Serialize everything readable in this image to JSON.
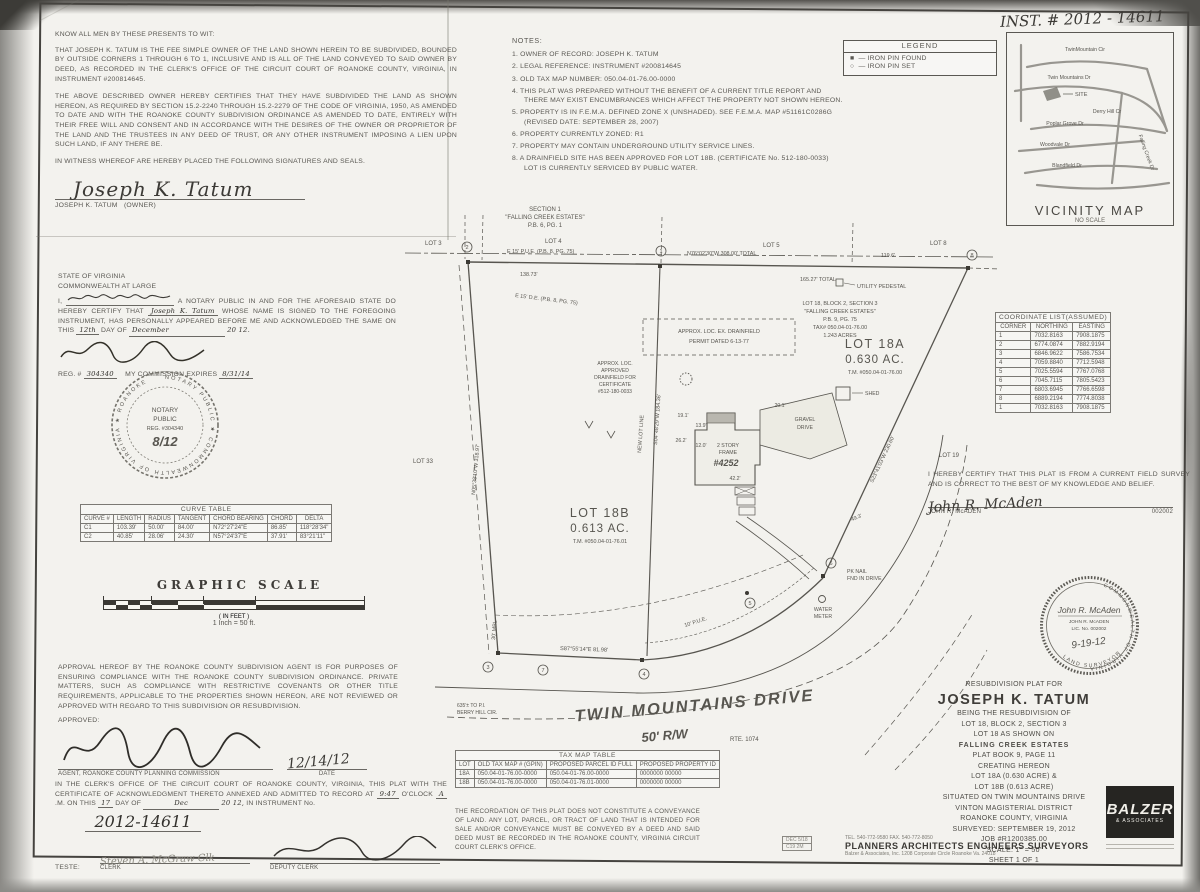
{
  "colors": {
    "paper": "#f3f2ee",
    "ink": "#57554f",
    "line": "#4c4a46",
    "hand": "#3c3a36",
    "logo_bg": "#262522"
  },
  "meta": {
    "inst_handwritten": "INST. # 2012 - 14611"
  },
  "owner": {
    "heading": "KNOW ALL MEN BY THESE PRESENTS TO WIT:",
    "p1": "THAT JOSEPH K. TATUM IS THE FEE SIMPLE OWNER OF THE LAND SHOWN HEREIN TO BE SUBDIVIDED, BOUNDED BY OUTSIDE CORNERS 1 THROUGH 6 TO 1, INCLUSIVE AND IS ALL OF THE LAND CONVEYED TO SAID OWNER BY DEED, AS RECORDED IN THE CLERK'S OFFICE OF THE CIRCUIT COURT OF ROANOKE COUNTY, VIRGINIA, IN INSTRUMENT #200814645.",
    "p2": "THE ABOVE DESCRIBED OWNER HEREBY CERTIFIES THAT THEY HAVE SUBDIVIDED THE LAND AS SHOWN HEREON, AS REQUIRED BY SECTION 15.2-2240 THROUGH 15.2-2279 OF THE CODE OF VIRGINIA, 1950, AS AMENDED TO DATE AND WITH THE ROANOKE COUNTY SUBDIVISION ORDINANCE AS AMENDED TO DATE, ENTIRELY WITH THEIR FREE WILL AND CONSENT AND IN ACCORDANCE WITH THE DESIRES OF THE OWNER OR PROPRIETOR OF THE LAND AND THE TRUSTEES IN ANY DEED OF TRUST, OR ANY OTHER INSTRUMENT IMPOSING A LIEN UPON SUCH LAND, IF ANY THERE BE.",
    "p3": "IN WITNESS WHEREOF ARE HEREBY PLACED THE FOLLOWING SIGNATURES AND SEALS.",
    "signature": "Joseph K. Tatum",
    "sig_name": "JOSEPH K. TATUM",
    "sig_role": "(OWNER)"
  },
  "notary": {
    "l1": "STATE OF VIRGINIA",
    "l2": "COMMONWEALTH AT LARGE",
    "lead": "I,",
    "after_name": "A NOTARY PUBLIC IN AND FOR THE AFORESAID STATE DO HEREBY CERTIFY THAT",
    "name_fill": "Joseph K. Tatum",
    "after2": "WHOSE NAME IS SIGNED TO THE FOREGOING INSTRUMENT, HAS PERSONALLY APPEARED BEFORE ME AND ACKNOWLEDGED THE SAME ON THIS",
    "day": "12th",
    "day_of": "DAY OF",
    "month": "December",
    "year": "20 12.",
    "reg_label": "REG. #",
    "reg": "304340",
    "comm_label": "MY COMMISSION EXPIRES",
    "comm_date": "8/31/14",
    "seal_ring": "NOTARY PUBLIC ★ COMMONWEALTH OF VIRGINIA ★ ROANOKE",
    "seal_l1": "NOTARY",
    "seal_l2": "PUBLIC",
    "seal_l3": "REG. #304340",
    "seal_hand": "8/12"
  },
  "notes": {
    "title": "NOTES:",
    "items": [
      "1.  OWNER OF RECORD: JOSEPH K. TATUM",
      "2.  LEGAL REFERENCE: INSTRUMENT #200814645",
      "3.  OLD TAX MAP NUMBER: 050.04-01-76.00-0000",
      "4.  THIS PLAT WAS PREPARED WITHOUT THE BENEFIT OF A CURRENT TITLE REPORT AND THERE MAY EXIST ENCUMBRANCES WHICH AFFECT THE PROPERTY NOT SHOWN HEREON.",
      "5.  PROPERTY IS IN F.E.M.A. DEFINED ZONE X (UNSHADED). SEE F.E.M.A. MAP #51161C0286G (REVISED DATE: SEPTEMBER 28, 2007)",
      "6.  PROPERTY CURRENTLY ZONED: R1",
      "7.  PROPERTY MAY CONTAIN UNDERGROUND UTILITY SERVICE LINES.",
      "8.  A DRAINFIELD SITE HAS BEEN APPROVED FOR LOT 18B. (CERTIFICATE No. 512-180-0033)  LOT IS CURRENTLY SERVICED BY PUBLIC WATER."
    ]
  },
  "legend": {
    "title": "LEGEND",
    "sym_found": "■",
    "lbl_found": "—  IRON PIN FOUND",
    "sym_set": "○",
    "lbl_set": "—  IRON PIN SET"
  },
  "vicinity": {
    "title": "VICINITY MAP",
    "subtitle": "NO SCALE",
    "streets": [
      "TwinMountain Cir",
      "Twin Mountains Dr",
      "SITE",
      "Derry Hill Cr",
      "Poplar Grove Dr",
      "Woodvale Dr",
      "Blandfield Dr",
      "Falling Creek Dr"
    ]
  },
  "coord_table": {
    "title": "COORDINATE LIST(ASSUMED)",
    "headers": [
      "CORNER",
      "NORTHING",
      "EASTING"
    ],
    "rows": [
      [
        "1",
        "7032.8163",
        "7908.1875"
      ],
      [
        "2",
        "6774.0874",
        "7882.9194"
      ],
      [
        "3",
        "6846.9622",
        "7586.7534"
      ],
      [
        "4",
        "7059.8840",
        "7712.5948"
      ],
      [
        "5",
        "7025.5594",
        "7767.0768"
      ],
      [
        "6",
        "7045.7115",
        "7805.5423"
      ],
      [
        "7",
        "6803.6945",
        "7766.6598"
      ],
      [
        "8",
        "6889.2194",
        "7774.8038"
      ],
      [
        "1",
        "7032.8163",
        "7908.1875"
      ]
    ]
  },
  "curve_table": {
    "title": "CURVE TABLE",
    "headers": [
      "CURVE #",
      "LENGTH",
      "RADIUS",
      "TANGENT",
      "CHORD BEARING",
      "CHORD",
      "DELTA"
    ],
    "rows": [
      [
        "C1",
        "103.39'",
        "50.00'",
        "84.00'",
        "N72°27'24\"E",
        "86.85'",
        "118°28'34\""
      ],
      [
        "C2",
        "40.85'",
        "28.06'",
        "24.30'",
        "N57°24'37\"E",
        "37.91'",
        "83°21'11\""
      ]
    ]
  },
  "scale_block": {
    "title": "GRAPHIC SCALE",
    "in_feet": "( IN FEET )",
    "ratio": "1 Inch = 50  ft."
  },
  "surveyor": {
    "cert": "I HEREBY CERTIFY THAT THIS PLAT IS FROM A CURRENT FIELD SURVEY AND IS CORRECT TO THE BEST OF MY KNOWLEDGE AND BELIEF.",
    "signature": "John R. McAden",
    "name": "JOHN R. McADEN",
    "number": "002002",
    "seal_ring_top": "COMMONWEALTH OF VIRGINIA",
    "seal_ring_bottom": "LAND SURVEYOR",
    "seal_sig": "John R. McAden",
    "seal_name": "JOHN R. McADEN",
    "seal_lic": "LIC. No. 002002",
    "seal_date": "9-19-12"
  },
  "approval": {
    "text": "APPROVAL HEREOF BY THE ROANOKE COUNTY SUBDIVISION AGENT IS FOR PURPOSES OF ENSURING COMPLIANCE WITH THE ROANOKE COUNTY SUBDIVISION ORDINANCE. PRIVATE MATTERS, SUCH AS COMPLIANCE WITH RESTRICTIVE COVENANTS OR OTHER TITLE REQUIREMENTS, APPLICABLE TO THE PROPERTIES SHOWN HEREON, ARE NOT REVIEWED OR APPROVED WITH REGARD TO THIS SUBDIVISION OR RESUBDIVISION.",
    "approved_label": "APPROVED:",
    "agent_label": "AGENT, ROANOKE COUNTY PLANNING COMMISSION",
    "date_value": "12/14/12",
    "date_label": "DATE"
  },
  "clerk": {
    "p1": "IN THE CLERK'S OFFICE OF THE CIRCUIT COURT OF ROANOKE COUNTY, VIRGINIA, THIS PLAT WITH THE CERTIFICATE OF ACKNOWLEDGMENT THERETO ANNEXED AND ADMITTED TO RECORD AT",
    "time": "9:47",
    "oclock": "O'CLOCK",
    "ampm": "A",
    "m_on": ".M. ON",
    "this": "THIS",
    "day": "17",
    "day_of": "DAY OF",
    "month": "Dec",
    "year": "20 12,",
    "in_instr": "IN INSTRUMENT No.",
    "instr_no": "2012-14611",
    "teste": "TESTE:",
    "clerk_hand": "Steven A. McGraw Clk",
    "clerk_label": "CLERK",
    "deputy_label": "DEPUTY CLERK"
  },
  "tax_table": {
    "title": "TAX MAP TABLE",
    "headers": [
      "LOT",
      "OLD TAX MAP # (GPIN)",
      "PROPOSED PARCEL ID FULL",
      "PROPOSED PROPERTY ID"
    ],
    "rows": [
      [
        "18A",
        "050.04-01-76.00-0000",
        "050.04-01-76.00-0000",
        "0000000 00000"
      ],
      [
        "18B",
        "050.04-01-76.00-0000",
        "050.04-01-76.01-0000",
        "0000000 00000"
      ]
    ]
  },
  "recordation": "THE RECORDATION OF THIS PLAT DOES NOT CONSTITUTE A CONVEYANCE OF LAND. ANY LOT, PARCEL, OR TRACT OF LAND THAT IS INTENDED FOR SALE AND/OR CONVEYANCE MUST BE CONVEYED BY A DEED AND SAID DEED MUST BE RECORDED IN THE ROANOKE COUNTY, VIRGINIA CIRCUIT COURT CLERK'S OFFICE.",
  "title_block": {
    "lines": [
      "RESUBDIVISION PLAT FOR",
      "JOSEPH K. TATUM",
      "BEING THE RESUBDIVISION OF",
      "LOT 18, BLOCK 2, SECTION 3",
      "LOT 18 AS SHOWN ON",
      "FALLING CREEK ESTATES",
      "PLAT BOOK 9, PAGE 11",
      "CREATING HEREON",
      "LOT 18A (0.630 ACRE) &",
      "LOT 18B (0.613 ACRE)",
      "SITUATED ON TWIN MOUNTAINS DRIVE",
      "VINTON MAGISTERIAL DISTRICT",
      "ROANOKE COUNTY, VIRGINIA",
      "SURVEYED: SEPTEMBER 19, 2012",
      "JOB #R1200385.00",
      "SCALE: 1\" = 50'",
      "SHEET 1 OF 1"
    ]
  },
  "firm": {
    "phone": "TEL. 540-772-9580   FAX. 540-772-8050",
    "disciplines": "PLANNERS    ARCHITECTS    ENGINEERS    SURVEYORS",
    "address": "Balzer & Associates, Inc.  1208 Corporate Circle  Roanoke Va. 24018",
    "logo_line1": "BALZER",
    "logo_line2": "& ASSOCIATES"
  },
  "stamps": {
    "row1": "DEC 5/18",
    "row2": "C19  2M"
  },
  "drawing": {
    "sec1": "SECTION 1",
    "sec2": "\"FALLING CREEK ESTATES\"",
    "sec3": "P.B. 6, PG. 1",
    "lot3": "LOT 3",
    "lot4": "LOT 4",
    "lot5": "LOT 5",
    "lot8": "LOT 8",
    "lot33": "LOT 33",
    "lot19": "LOT 19",
    "pue_top": "E 15' P.U.E. (P.B. 8, PG. 75)",
    "bearing_top": "N76°02'30\"W 308.00' TOTAL",
    "dim_a": "138.73'",
    "dim_b": "165.27' TOTAL",
    "dim_c": "119.6'",
    "de_line": "E 15' D.E. (P.B. 8, PG. 75)",
    "utility": "UTILITY PEDESTAL",
    "parent1": "LOT 18, BLOCK 2, SECTION 3",
    "parent2": "\"FALLING CREEK ESTATES\"",
    "parent3": "P.B. 9, PG. 75",
    "parent4": "TAX# 050.04-01-76.00",
    "parent5": "1.243 ACRES",
    "lot18a_1": "LOT 18A",
    "lot18a_2": "0.630 AC.",
    "lot18a_3": "T.M. #050.04-01-76.00",
    "lot18b_1": "LOT 18B",
    "lot18b_2": "0.613 AC.",
    "lot18b_3": "T.M. #050.04-01-76.01",
    "new_lot_line": "NEW LOT LINE",
    "new_lot_bearing": "S04°48'29\"W 184.36'",
    "left_bearing": "N05°38'10\"W 318.97'",
    "right_bearing": "S23°41'03\"W 230.60'",
    "df_a1": "APPROX. LOC. EX. DRAINFIELD",
    "df_a2": "PERMIT DATED 6-13-77",
    "df_b1": "APPROX. LOC.",
    "df_b2": "APPROVED",
    "df_b3": "DRAINFIELD FOR",
    "df_b4": "CERTIFICATE",
    "df_b5": "#512-180-0033",
    "shed": "SHED",
    "house1": "2 STORY",
    "house2": "FRAME",
    "house3": "#4252",
    "house_dim": "42.2'",
    "gravel1": "GRAVEL",
    "gravel2": "DRIVE",
    "d1": "19.1'",
    "d2": "13.9'",
    "d3": "26.2'",
    "d4": "12.0'",
    "d5": "20.1'",
    "d6": "49.3'",
    "pk1": "PK NAIL",
    "pk2": "FND IN DRIVE",
    "wm1": "WATER",
    "wm2": "METER",
    "pue_curve": "10' P.U.E.",
    "mbl": "30' MBL",
    "road_bearing": "S87°55'14\"E 81.98'",
    "road_name": "TWIN MOUNTAINS DRIVE",
    "road_rw": "50' R/W",
    "road_rte": "RTE. 1074",
    "pi1": "635'± TO P.I.",
    "pi2": "BERRY HILL CIR.",
    "c1": "1",
    "c2": "2",
    "c3": "3",
    "c4": "4",
    "c5": "5",
    "c6": "6",
    "c7": "7",
    "c8": "8"
  }
}
